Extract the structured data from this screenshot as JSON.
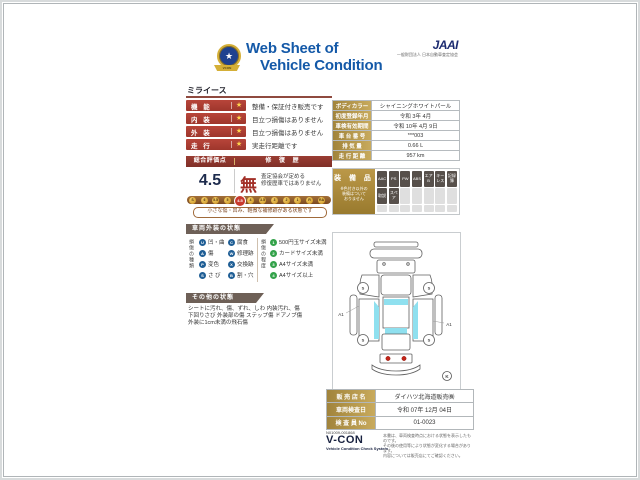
{
  "header": {
    "title_line1": "Web Sheet of",
    "title_line2": "Vehicle Condition",
    "jaai_logo": "JAAI",
    "jaai_subtext": "一般財団法人 日本自動車査定協会",
    "emblem_star": "★",
    "emblem_ribbon": "VCON"
  },
  "vehicle_name": "ミライース",
  "ratings": {
    "rows": [
      {
        "label": "機 能",
        "star": "★",
        "desc": "整備・保証付き販売です"
      },
      {
        "label": "内 装",
        "star": "★",
        "desc": "目立つ損傷はありません"
      },
      {
        "label": "外 装",
        "star": "★",
        "desc": "目立つ損傷はありません"
      },
      {
        "label": "走 行",
        "star": "★",
        "desc": "実走行距離です"
      }
    ]
  },
  "evaluation": {
    "score_header": "総合評価点",
    "repair_header": "修 復 歴",
    "score": "4.5",
    "repair_value": "無",
    "repair_note_line1": "査定協会が定める",
    "repair_note_line2": "修復歴車ではありません",
    "scale": [
      "S",
      "6",
      "5.5",
      "5",
      "4.5",
      "4",
      "3.5",
      "3",
      "2",
      "1",
      "R",
      "RA"
    ],
    "active_grade": "4.5",
    "caption": "小さな傷・凹み、軽微な補修跡がある状態です"
  },
  "vehicle_info": {
    "rows": [
      {
        "label": "ボディカラー",
        "value": "シャイニングホワイトパール"
      },
      {
        "label": "初度登録年月",
        "value": "令和 3年 4月"
      },
      {
        "label": "車検有効期間",
        "value": "令和 10年 4月 9日"
      },
      {
        "label": "車 台 番 号",
        "value": "***003"
      },
      {
        "label": "排 気 量",
        "value": "0.66 L"
      },
      {
        "label": "走 行 距 離",
        "value": "957 km"
      }
    ]
  },
  "equipment": {
    "title": "装 備 品",
    "note_line1": "※色付き以外の",
    "note_line2": "装備はついて",
    "note_line3": "おりません",
    "badges": [
      "AAC",
      "PS",
      "PW",
      "ABS",
      "エアB",
      "キーレス",
      "記録簿",
      "取説",
      "スペア"
    ]
  },
  "exterior": {
    "banner": "車両外装の状態",
    "type_label": "損傷の種類",
    "types": [
      {
        "code": "U",
        "label": "凹・曲"
      },
      {
        "code": "A",
        "label": "傷"
      },
      {
        "code": "P",
        "label": "変色"
      },
      {
        "code": "S",
        "label": "さ び"
      },
      {
        "code": "C",
        "label": "腐食"
      },
      {
        "code": "W",
        "label": "修理跡"
      },
      {
        "code": "X",
        "label": "交換跡"
      },
      {
        "code": "B",
        "label": "割・穴"
      }
    ],
    "degree_label": "損傷の程度",
    "degrees": [
      {
        "code": "1",
        "label": "500円玉サイズ未満"
      },
      {
        "code": "2",
        "label": "カードサイズ未満"
      },
      {
        "code": "3",
        "label": "A4サイズ未満"
      },
      {
        "code": "4",
        "label": "A4サイズ以上"
      }
    ]
  },
  "other_condition": {
    "banner": "その他の状態",
    "line1": "シートに汚れ、傷、ずれ、しわ 内装汚れ、傷",
    "line2": "下回りさび 外装部の傷 ステップ傷 ドアノブ傷",
    "line3": "外装に1cm未満の飛石傷"
  },
  "diagram": {
    "marker_left": "A1",
    "marker_right": "A1",
    "wheel_code": "S",
    "corner_code": "K"
  },
  "dealer": {
    "rows": [
      {
        "label": "販 売 店 名",
        "value": "ダイハツ北海道販売㈱"
      },
      {
        "label": "車両検査日",
        "value": "令和 07年 12月 04日"
      },
      {
        "label": "検 査 員 No",
        "value": "01-0023"
      }
    ]
  },
  "footer": {
    "serial": "N01009-001868",
    "logo": "V-CON",
    "logo_sub": "Vehicle Condition Check System",
    "disclaimer_line1": "本書は、車両検査時点における状態を表示したものです。",
    "disclaimer_line2": "その後の使用等により状態が変化する場合があります。",
    "disclaimer_line3": "内容については販売店にてご確認ください。"
  }
}
